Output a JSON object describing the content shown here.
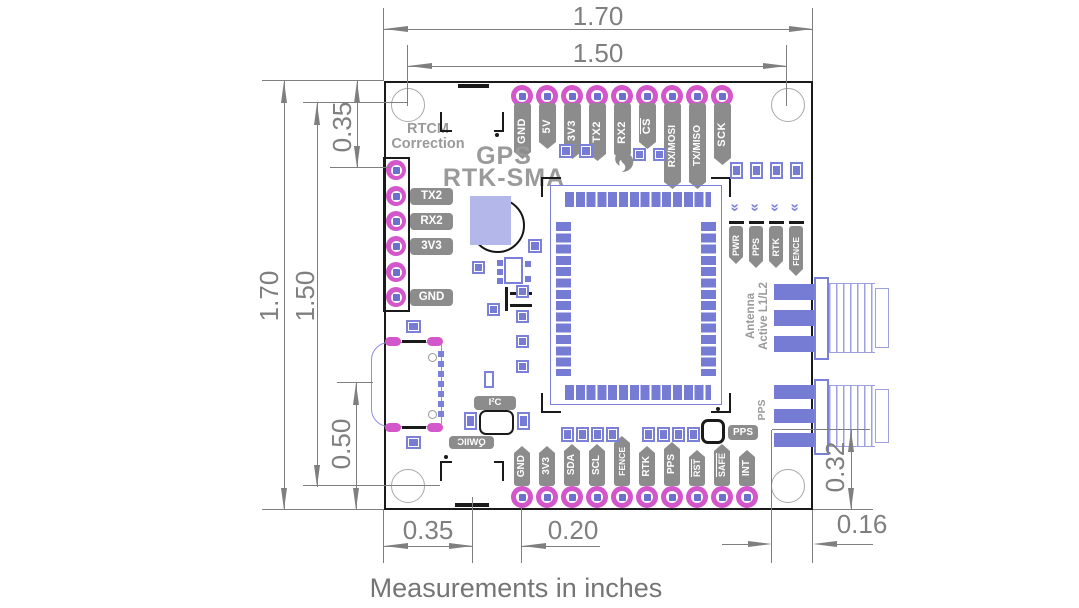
{
  "caption": "Measurements in inches",
  "silkscreen": {
    "product_line1": "GPS",
    "product_line2": "RTK-SMA",
    "rtcm_line1": "RTCM",
    "rtcm_line2": "Correction",
    "antenna_line1": "Antenna",
    "antenna_line2": "Active L1/L2",
    "pps_sma": "PPS",
    "i2c": "I²C",
    "qwiic": "QWIIC",
    "pps_button": "PPS"
  },
  "dimensions": {
    "top_outer": "1.70",
    "top_inner": "1.50",
    "left_outer": "1.70",
    "left_inner": "1.50",
    "left_top": "0.35",
    "left_bottom": "0.50",
    "bottom_left": "0.35",
    "bottom_center": "0.20",
    "bottom_right": "0.16",
    "right_bottom": "0.32"
  },
  "pins": {
    "top": [
      "GND",
      "5V",
      "3V3",
      "TX2",
      "RX2",
      "CS",
      "RX/MOSI",
      "TX/MISO",
      "SCK"
    ],
    "bottom": [
      "GND",
      "3V3",
      "SDA",
      "SCL",
      "FENCE",
      "RTK",
      "PPS",
      "RST",
      "SAFE",
      "INT"
    ],
    "rtcm": [
      "TX2",
      "RX2",
      "3V3",
      "GND"
    ],
    "leds": [
      "PWR",
      "PPS",
      "RTK",
      "FENCE"
    ]
  },
  "colors": {
    "pad_ring": "#d356ca",
    "copper": "#767bd4",
    "copper_outline": "#7b80d8",
    "silkscreen_gray": "#9a9a9a",
    "label_gray": "#8c8c8c",
    "dimension_gray": "#7f7f7f",
    "lavender": "#b3b7ea",
    "board_outline": "#1a1a1a"
  }
}
